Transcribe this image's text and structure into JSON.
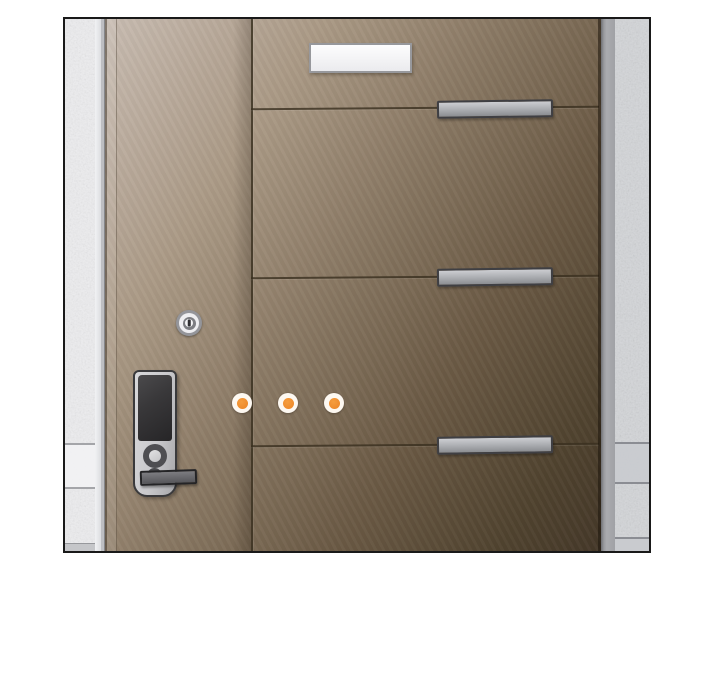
{
  "scene": {
    "type": "webtoon-panel-illustration",
    "description": "Front view of a modern brown apartment entrance door with a digital keypad lock; three orange beep indicator dots glow beside the lock. Textured concrete walls flank the door; a blank white nameplate sits near the top and three horizontal metal trim bars cross the right half of the door.",
    "objects": {
      "door": {
        "label": "brown paneled front door",
        "right_side_panels": 4,
        "handle_trim_bars": 3,
        "vertical_seam": 1
      },
      "digital_lock": {
        "label": "digital keypad door lock",
        "parts": [
          "touch-keypad",
          "round-dial-button",
          "keyhole",
          "lever-handle"
        ]
      },
      "key_cylinder": {
        "label": "round key cylinder with vertical slot"
      },
      "nameplate": {
        "label": "blank white nameplate"
      },
      "beep_dots": {
        "count": 3,
        "label": "orange beep indicator dots"
      },
      "walls": {
        "left": "white speckled tile wall",
        "right": "gray speckled tile wall"
      }
    },
    "colors": {
      "page_bg": "#ffffff",
      "frame_border": "#191919",
      "door_light": "#c8bcb2",
      "door_mid": "#8d7c67",
      "door_dark": "#453829",
      "seam": "#3a3020",
      "metal_light": "#cdced2",
      "metal_dark": "#8b8d91",
      "lock_body": "#c9c9cc",
      "keypad": "#39383a",
      "wall_left": "#ededef",
      "wall_right": "#d3d5d8",
      "dot_ring": "#fdf8f1",
      "dot_core": "#ee8b2c"
    }
  }
}
